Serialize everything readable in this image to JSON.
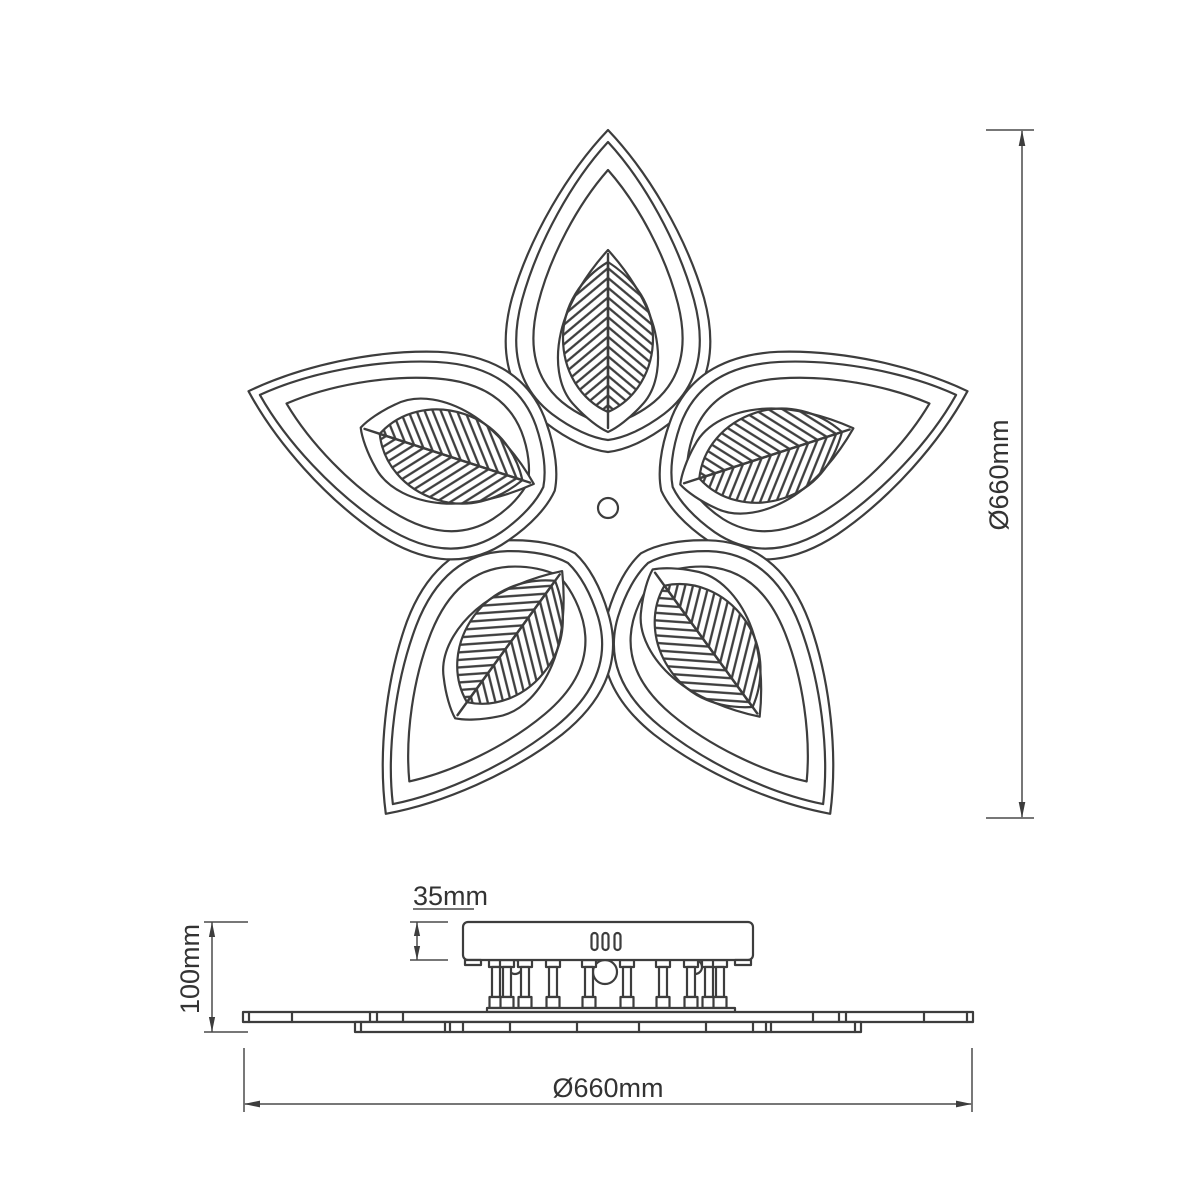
{
  "dimensions": {
    "flower_diameter": {
      "label": "Ø660mm"
    },
    "base_diameter": {
      "label": "Ø660mm"
    },
    "canopy_height": {
      "label": "35mm"
    },
    "fixture_height": {
      "label": "100mm"
    }
  },
  "colors": {
    "line": "#3d3d3d",
    "dimension_line": "#4a4a4a",
    "text": "#333333",
    "background": "#ffffff"
  }
}
